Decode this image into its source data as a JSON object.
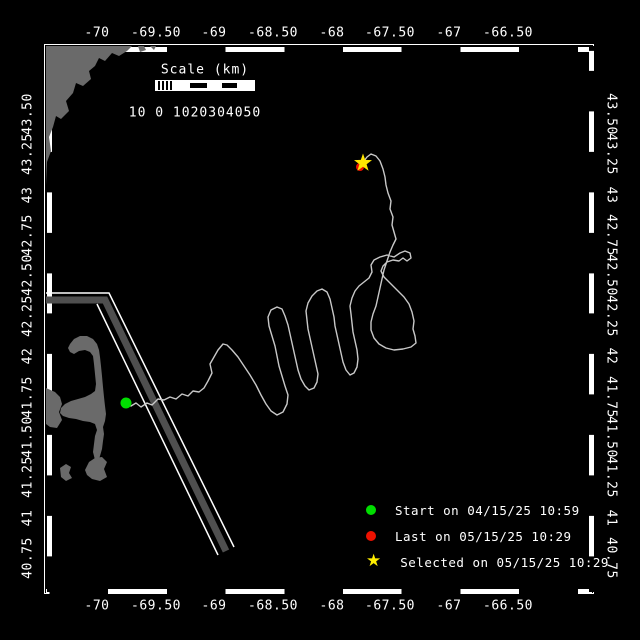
{
  "map_view": {
    "axes": {
      "lon": [
        {
          "label": "-70",
          "x": 97
        },
        {
          "label": "-69.50",
          "x": 156
        },
        {
          "label": "-69",
          "x": 214
        },
        {
          "label": "-68.50",
          "x": 273
        },
        {
          "label": "-68",
          "x": 332
        },
        {
          "label": "-67.50",
          "x": 390
        },
        {
          "label": "-67",
          "x": 449
        },
        {
          "label": "-66.50",
          "x": 508
        }
      ],
      "lat": [
        {
          "label": "43.50",
          "y": 114
        },
        {
          "label": "43.25",
          "y": 154
        },
        {
          "label": "43",
          "y": 195
        },
        {
          "label": "42.75",
          "y": 235
        },
        {
          "label": "42.50",
          "y": 275
        },
        {
          "label": "42.25",
          "y": 316
        },
        {
          "label": "42",
          "y": 356
        },
        {
          "label": "41.75",
          "y": 397
        },
        {
          "label": "41.50",
          "y": 437
        },
        {
          "label": "41.25",
          "y": 477
        },
        {
          "label": "41",
          "y": 518
        },
        {
          "label": "40.75",
          "y": 558
        }
      ]
    },
    "scale_bar": {
      "title": "Scale (km)",
      "tick_text": "10 0 1020304050"
    },
    "legend": [
      {
        "marker": "start-dot",
        "color": "#00dd00",
        "label": "Start on 04/15/25 10:59",
        "row_y": 502
      },
      {
        "marker": "last-dot",
        "color": "#ee1100",
        "label": "Last on 05/15/25 10:29",
        "row_y": 528
      },
      {
        "marker": "selected-star",
        "color": "#ffee00",
        "label": "Selected on 05/15/25 10:29",
        "row_y": 554
      }
    ],
    "markers": {
      "start": {
        "x": 126,
        "y": 403
      },
      "last": {
        "x": 360,
        "y": 167
      },
      "selected": {
        "x": 363,
        "y": 163
      }
    },
    "colors": {
      "background": "#000000",
      "frame": "#ffffff",
      "land": "#6a6a6a",
      "track": "#c8c8c8",
      "lane_band": "#4f4f4f",
      "lane_edge": "#ffffff",
      "start": "#00dd00",
      "last": "#ee1100",
      "selected": "#ffe600"
    },
    "geometry": {
      "land_polygons": [
        [
          [
            46,
            46
          ],
          [
            132,
            46
          ],
          [
            127,
            51
          ],
          [
            119,
            56
          ],
          [
            112,
            53
          ],
          [
            105,
            61
          ],
          [
            99,
            58
          ],
          [
            95,
            66
          ],
          [
            89,
            71
          ],
          [
            91,
            79
          ],
          [
            83,
            86
          ],
          [
            76,
            83
          ],
          [
            73,
            93
          ],
          [
            66,
            101
          ],
          [
            69,
            111
          ],
          [
            61,
            119
          ],
          [
            56,
            116
          ],
          [
            53,
            127
          ],
          [
            49,
            137
          ],
          [
            51,
            151
          ],
          [
            47,
            162
          ],
          [
            46,
            185
          ]
        ],
        [
          [
            138,
            46
          ],
          [
            144,
            46
          ],
          [
            146,
            50
          ],
          [
            140,
            52
          ]
        ],
        [
          [
            150,
            46
          ],
          [
            156,
            46
          ],
          [
            154,
            50
          ]
        ],
        [
          [
            70,
            344
          ],
          [
            74,
            339
          ],
          [
            80,
            336
          ],
          [
            87,
            336
          ],
          [
            93,
            339
          ],
          [
            97,
            344
          ],
          [
            99,
            350
          ],
          [
            100,
            357
          ],
          [
            101,
            366
          ],
          [
            102,
            376
          ],
          [
            103,
            387
          ],
          [
            104,
            397
          ],
          [
            105,
            406
          ],
          [
            106,
            414
          ],
          [
            105,
            421
          ],
          [
            103,
            427
          ],
          [
            104,
            434
          ],
          [
            103,
            441
          ],
          [
            102,
            449
          ],
          [
            100,
            456
          ],
          [
            98,
            462
          ],
          [
            95,
            460
          ],
          [
            93,
            452
          ],
          [
            94,
            444
          ],
          [
            95,
            436
          ],
          [
            97,
            430
          ],
          [
            95,
            424
          ],
          [
            90,
            422
          ],
          [
            83,
            421
          ],
          [
            76,
            419
          ],
          [
            69,
            418
          ],
          [
            63,
            416
          ],
          [
            60,
            413
          ],
          [
            61,
            408
          ],
          [
            65,
            404
          ],
          [
            71,
            401
          ],
          [
            78,
            399
          ],
          [
            85,
            397
          ],
          [
            91,
            394
          ],
          [
            95,
            391
          ],
          [
            96,
            384
          ],
          [
            95,
            374
          ],
          [
            94,
            364
          ],
          [
            93,
            356
          ],
          [
            90,
            352
          ],
          [
            85,
            350
          ],
          [
            79,
            351
          ],
          [
            74,
            354
          ],
          [
            70,
            352
          ],
          [
            68,
            348
          ]
        ],
        [
          [
            46,
            388
          ],
          [
            55,
            392
          ],
          [
            60,
            397
          ],
          [
            62,
            404
          ],
          [
            59,
            412
          ],
          [
            62,
            420
          ],
          [
            57,
            428
          ],
          [
            50,
            427
          ],
          [
            46,
            424
          ]
        ],
        [
          [
            60,
            468
          ],
          [
            66,
            464
          ],
          [
            71,
            467
          ],
          [
            69,
            473
          ],
          [
            72,
            478
          ],
          [
            66,
            481
          ],
          [
            61,
            477
          ]
        ],
        [
          [
            85,
            470
          ],
          [
            89,
            462
          ],
          [
            95,
            458
          ],
          [
            102,
            457
          ],
          [
            107,
            462
          ],
          [
            104,
            469
          ],
          [
            107,
            477
          ],
          [
            100,
            481
          ],
          [
            92,
            479
          ],
          [
            87,
            475
          ]
        ]
      ],
      "traffic_lane": {
        "band": [
          [
            46,
            300
          ],
          [
            105,
            300
          ],
          [
            226,
            551
          ]
        ],
        "edge_a": [
          [
            46,
            293
          ],
          [
            109,
            293
          ],
          [
            234,
            547
          ]
        ],
        "edge_b": [
          [
            97,
            304
          ],
          [
            218,
            555
          ]
        ],
        "band_width": 7,
        "edge_width": 1.5
      },
      "track": [
        [
          126,
          403
        ],
        [
          131,
          406
        ],
        [
          136,
          403
        ],
        [
          141,
          407
        ],
        [
          147,
          403
        ],
        [
          152,
          405
        ],
        [
          158,
          399
        ],
        [
          164,
          400
        ],
        [
          170,
          397
        ],
        [
          176,
          399
        ],
        [
          182,
          394
        ],
        [
          188,
          396
        ],
        [
          193,
          391
        ],
        [
          199,
          392
        ],
        [
          204,
          388
        ],
        [
          208,
          381
        ],
        [
          212,
          373
        ],
        [
          210,
          364
        ],
        [
          214,
          357
        ],
        [
          218,
          350
        ],
        [
          223,
          344
        ],
        [
          227,
          345
        ],
        [
          232,
          350
        ],
        [
          238,
          357
        ],
        [
          244,
          366
        ],
        [
          250,
          375
        ],
        [
          256,
          385
        ],
        [
          261,
          395
        ],
        [
          266,
          404
        ],
        [
          271,
          411
        ],
        [
          277,
          415
        ],
        [
          283,
          412
        ],
        [
          287,
          404
        ],
        [
          288,
          395
        ],
        [
          285,
          386
        ],
        [
          282,
          376
        ],
        [
          279,
          366
        ],
        [
          277,
          356
        ],
        [
          275,
          346
        ],
        [
          272,
          336
        ],
        [
          269,
          326
        ],
        [
          268,
          317
        ],
        [
          271,
          310
        ],
        [
          277,
          307
        ],
        [
          282,
          309
        ],
        [
          285,
          316
        ],
        [
          288,
          325
        ],
        [
          290,
          334
        ],
        [
          292,
          343
        ],
        [
          294,
          352
        ],
        [
          296,
          361
        ],
        [
          298,
          370
        ],
        [
          301,
          379
        ],
        [
          305,
          386
        ],
        [
          309,
          390
        ],
        [
          314,
          388
        ],
        [
          317,
          382
        ],
        [
          318,
          374
        ],
        [
          316,
          365
        ],
        [
          314,
          356
        ],
        [
          312,
          347
        ],
        [
          310,
          338
        ],
        [
          308,
          329
        ],
        [
          307,
          320
        ],
        [
          306,
          311
        ],
        [
          308,
          303
        ],
        [
          312,
          296
        ],
        [
          317,
          291
        ],
        [
          322,
          289
        ],
        [
          327,
          292
        ],
        [
          330,
          299
        ],
        [
          332,
          308
        ],
        [
          334,
          317
        ],
        [
          335,
          326
        ],
        [
          337,
          335
        ],
        [
          339,
          344
        ],
        [
          341,
          353
        ],
        [
          343,
          362
        ],
        [
          346,
          370
        ],
        [
          350,
          375
        ],
        [
          354,
          373
        ],
        [
          357,
          367
        ],
        [
          358,
          359
        ],
        [
          357,
          350
        ],
        [
          355,
          341
        ],
        [
          353,
          332
        ],
        [
          352,
          323
        ],
        [
          351,
          314
        ],
        [
          350,
          306
        ],
        [
          352,
          298
        ],
        [
          355,
          291
        ],
        [
          359,
          286
        ],
        [
          364,
          282
        ],
        [
          369,
          278
        ],
        [
          372,
          272
        ],
        [
          371,
          265
        ],
        [
          374,
          260
        ],
        [
          380,
          257
        ],
        [
          387,
          255
        ],
        [
          394,
          257
        ],
        [
          400,
          253
        ],
        [
          405,
          251
        ],
        [
          410,
          253
        ],
        [
          411,
          258
        ],
        [
          407,
          261
        ],
        [
          403,
          258
        ],
        [
          399,
          261
        ],
        [
          393,
          260
        ],
        [
          387,
          262
        ],
        [
          383,
          266
        ],
        [
          381,
          271
        ],
        [
          384,
          277
        ],
        [
          390,
          283
        ],
        [
          397,
          290
        ],
        [
          404,
          297
        ],
        [
          409,
          304
        ],
        [
          412,
          312
        ],
        [
          414,
          321
        ],
        [
          413,
          329
        ],
        [
          415,
          336
        ],
        [
          416,
          343
        ],
        [
          411,
          347
        ],
        [
          403,
          349
        ],
        [
          394,
          350
        ],
        [
          386,
          348
        ],
        [
          379,
          344
        ],
        [
          374,
          338
        ],
        [
          371,
          330
        ],
        [
          371,
          322
        ],
        [
          373,
          314
        ],
        [
          376,
          306
        ],
        [
          378,
          297
        ],
        [
          380,
          288
        ],
        [
          382,
          279
        ],
        [
          384,
          270
        ],
        [
          387,
          261
        ],
        [
          390,
          252
        ],
        [
          393,
          245
        ],
        [
          396,
          239
        ],
        [
          394,
          232
        ],
        [
          392,
          225
        ],
        [
          393,
          217
        ],
        [
          390,
          209
        ],
        [
          391,
          201
        ],
        [
          388,
          193
        ],
        [
          386,
          185
        ],
        [
          385,
          177
        ],
        [
          383,
          169
        ],
        [
          380,
          161
        ],
        [
          376,
          156
        ],
        [
          371,
          154
        ],
        [
          367,
          157
        ],
        [
          364,
          161
        ]
      ]
    }
  }
}
